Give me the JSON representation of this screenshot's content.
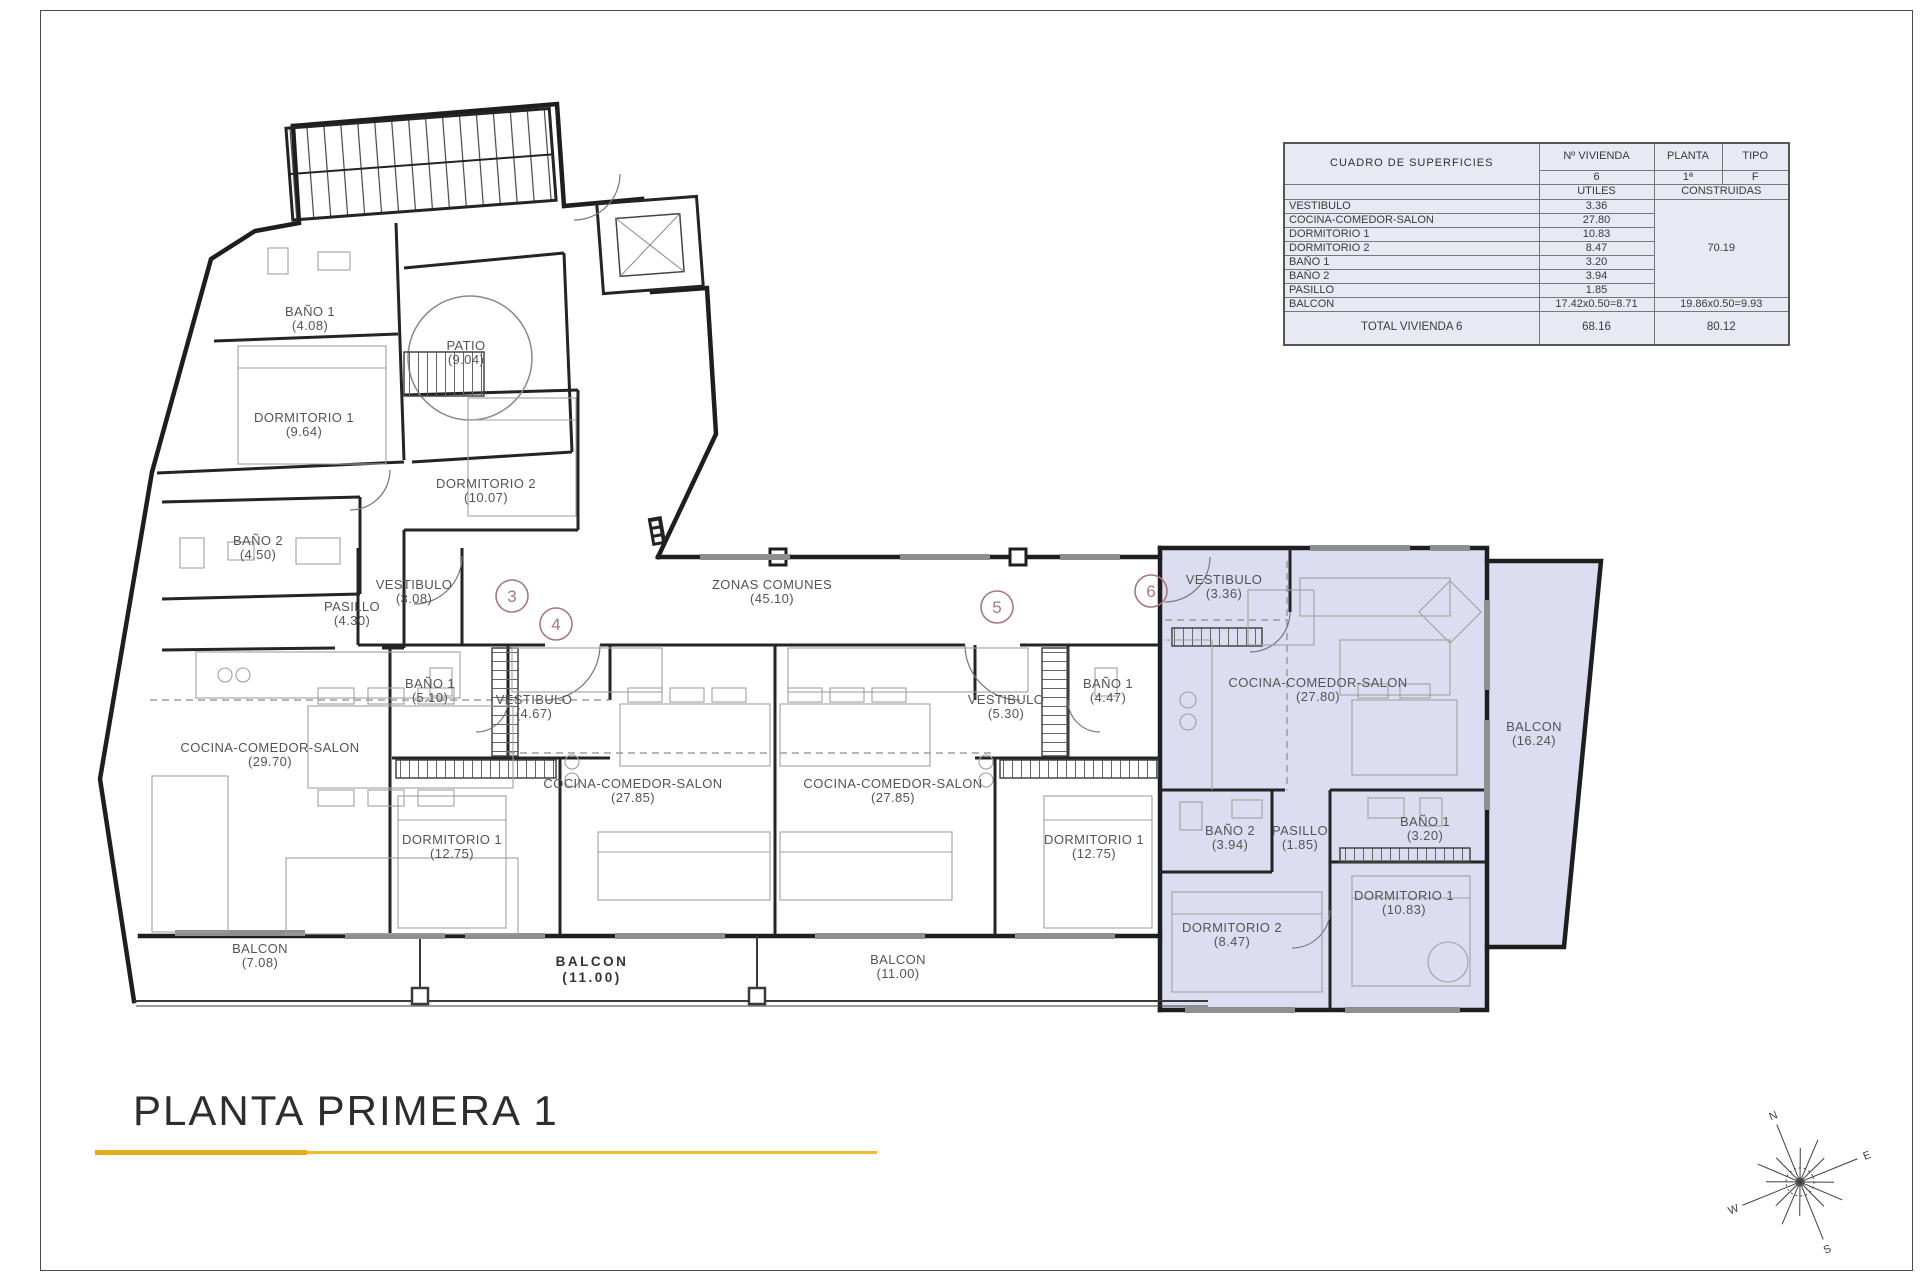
{
  "page": {
    "title": "PLANTA PRIMERA 1"
  },
  "table": {
    "title": "CUADRO DE SUPERFICIES",
    "header": {
      "vivienda_label": "Nº VIVIENDA",
      "vivienda_value": "6",
      "planta_label": "PLANTA",
      "planta_value": "1ª",
      "tipo_label": "TIPO",
      "tipo_value": "F",
      "utiles": "UTILES",
      "construidas": "CONSTRUIDAS"
    },
    "rows": [
      {
        "label": "VESTIBULO",
        "utiles": "3.36"
      },
      {
        "label": "COCINA-COMEDOR-SALON",
        "utiles": "27.80"
      },
      {
        "label": "DORMITORIO 1",
        "utiles": "10.83"
      },
      {
        "label": "DORMITORIO 2",
        "utiles": "8.47"
      },
      {
        "label": "BAÑO 1",
        "utiles": "3.20"
      },
      {
        "label": "BAÑO 2",
        "utiles": "3.94"
      },
      {
        "label": "PASILLO",
        "utiles": "1.85"
      },
      {
        "label": "BALCON",
        "utiles": "17.42x0.50=8.71",
        "construidas": "19.86x0.50=9.93"
      }
    ],
    "construidas_total": "70.19",
    "total": {
      "label": "TOTAL VIVIENDA 6",
      "utiles": "68.16",
      "construidas": "80.12"
    }
  },
  "plan": {
    "rooms": [
      {
        "name": "BAÑO 1",
        "area": "(4.08)"
      },
      {
        "name": "PATIO",
        "area": "(9.04)"
      },
      {
        "name": "DORMITORIO 1",
        "area": "(9.64)"
      },
      {
        "name": "DORMITORIO 2",
        "area": "(10.07)"
      },
      {
        "name": "BAÑO 2",
        "area": "(4.50)"
      },
      {
        "name": "VESTIBULO",
        "area": "(3.08)"
      },
      {
        "name": "PASILLO",
        "area": "(4.30)"
      },
      {
        "name": "COCINA-COMEDOR-SALON",
        "area": "(29.70)"
      },
      {
        "name": "BAÑO 1",
        "area": "(5.10)"
      },
      {
        "name": "VESTIBULO",
        "area": "(4.67)"
      },
      {
        "name": "ZONAS COMUNES",
        "area": "(45.10)"
      },
      {
        "name": "COCINA-COMEDOR-SALON",
        "area": "(27.85)"
      },
      {
        "name": "COCINA-COMEDOR-SALON",
        "area": "(27.85)"
      },
      {
        "name": "VESTIBULO",
        "area": "(5.30)"
      },
      {
        "name": "BAÑO 1",
        "area": "(4.47)"
      },
      {
        "name": "DORMITORIO 1",
        "area": "(12.75)"
      },
      {
        "name": "DORMITORIO 1",
        "area": "(12.75)"
      },
      {
        "name": "VESTIBULO",
        "area": "(3.36)"
      },
      {
        "name": "COCINA-COMEDOR-SALON",
        "area": "(27.80)"
      },
      {
        "name": "BALCON",
        "area": "(16.24)"
      },
      {
        "name": "BAÑO 2",
        "area": "(3.94)"
      },
      {
        "name": "PASILLO",
        "area": "(1.85)"
      },
      {
        "name": "BAÑO 1",
        "area": "(3.20)"
      },
      {
        "name": "DORMITORIO 2",
        "area": "(8.47)"
      },
      {
        "name": "DORMITORIO 1",
        "area": "(10.83)"
      },
      {
        "name": "BALCON",
        "area": "(7.08)"
      },
      {
        "name": "BALCON",
        "area": "(11.00)"
      },
      {
        "name": "BALCON",
        "area": "(11.00)"
      }
    ],
    "units": [
      "3",
      "4",
      "5",
      "6"
    ],
    "highlight_color": "#dcddf1",
    "accent_gold": "#e5ad18",
    "circle_color": "#aa767e"
  },
  "compass": {
    "n": "N",
    "e": "E",
    "s": "S",
    "w": "W"
  }
}
